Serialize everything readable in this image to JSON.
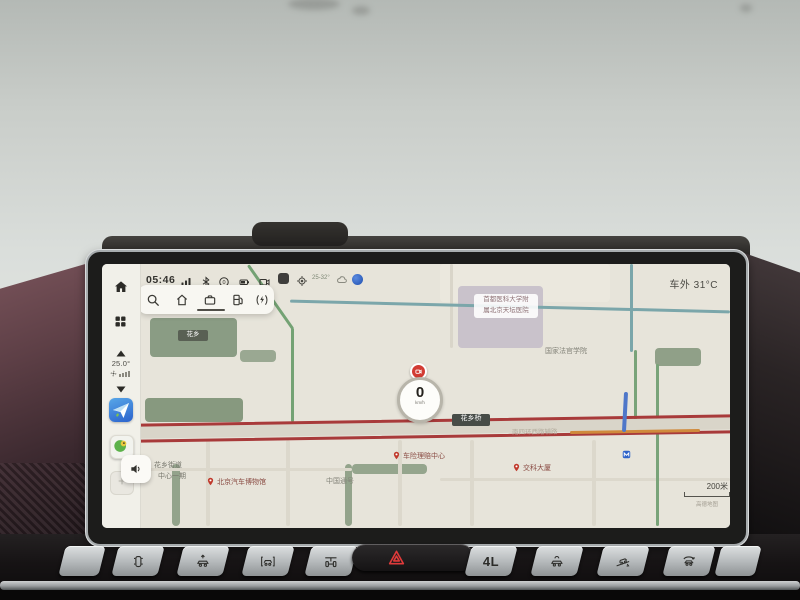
{
  "status_bar": {
    "time": "05:46",
    "outside_temp": "车外 31°C",
    "weather_range": "25-32°"
  },
  "sidebar": {
    "cabin_temp": "25.0°"
  },
  "map": {
    "speed": {
      "value": "0",
      "unit": "km/h"
    },
    "scale_label": "200米",
    "watermark": "高德地图",
    "signs": {
      "park": "花乡",
      "bridge": "花乡桥",
      "road": "南四环西路辅路"
    },
    "labels": {
      "hospital_line1": "首都医科大学附",
      "hospital_line2": "属北京天坛医院",
      "judges_college": "国家法官学院",
      "crsc": "中国通号",
      "block_line1": "花乡街道",
      "block_line2": "中心一期"
    },
    "pois": [
      {
        "label": "北京汽车博物馆"
      },
      {
        "label": "车险理赔中心"
      },
      {
        "label": "交科大厦"
      }
    ]
  },
  "hard_buttons": {
    "four_low": "4L"
  },
  "colors": {
    "congested_road": "#a83a3a",
    "smooth_road": "#79a379",
    "accent_blue": "#2f63c9",
    "hazard_red": "#e03a3a"
  }
}
